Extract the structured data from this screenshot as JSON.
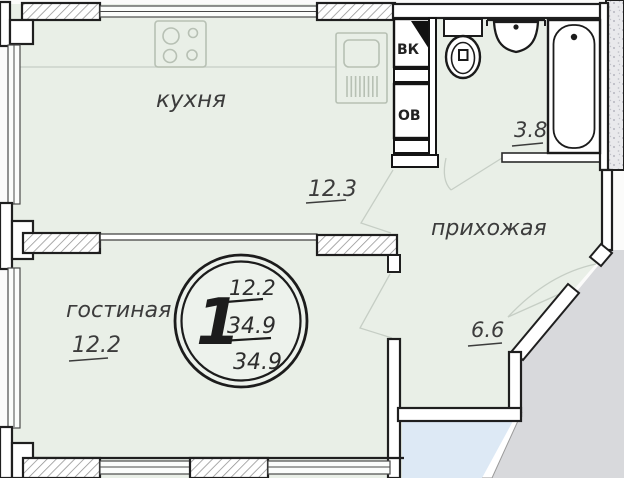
{
  "plan": {
    "type": "apartment-floor-plan",
    "rooms": {
      "kitchen": {
        "label": "кухня",
        "area": "12.3"
      },
      "living": {
        "label": "гостиная",
        "area": "12.2"
      },
      "hallway": {
        "label": "прихожая",
        "area": "6.6"
      },
      "bathroom": {
        "area": "3.8"
      }
    },
    "shafts": {
      "vk": "ВК",
      "ov": "ОВ"
    },
    "stamp": {
      "rooms_count": "1",
      "living_area": "12.2",
      "total_area": "34.9",
      "overall_area": "34.9"
    },
    "colors": {
      "floor": "#e9efe7",
      "page": "#fbfbfa",
      "outside_grey": "#d8d9dc",
      "adjacent_blue": "#dde9f5",
      "wall_line": "#1f1f1f",
      "faint_line": "#c6cec5",
      "fixture_faint": "#b7c0b4",
      "text": "#3c3c3c"
    }
  }
}
